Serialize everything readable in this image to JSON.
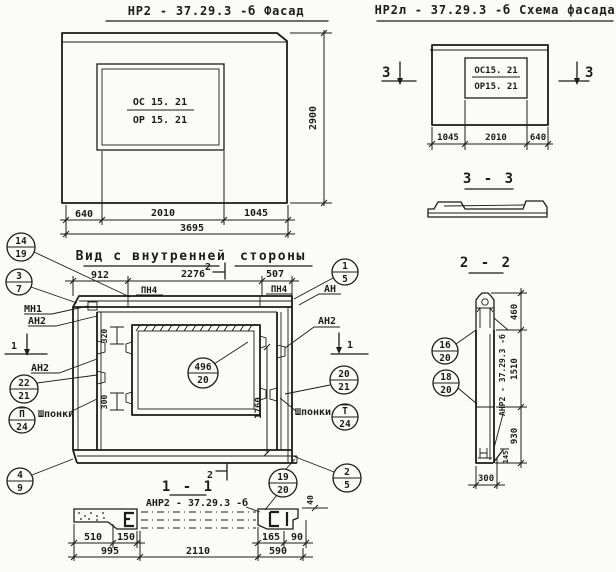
{
  "colors": {
    "ink": "#1b1b19",
    "paper": "#fbfbf8"
  },
  "facade": {
    "title": "НР2 - 37.29.3  -б   Фасад",
    "win_top": "ОС 15. 21",
    "win_bot": "ОР 15. 21",
    "dim_height": "2900",
    "dim_left": "640",
    "dim_mid": "2010",
    "dim_right": "1045",
    "dim_total": "3695"
  },
  "scheme": {
    "title": "НР2л - 37.29.3  -б  Схема фасада",
    "win_top": "ОС15. 21",
    "win_bot": "ОР15. 21",
    "dim_left": "1045",
    "dim_mid": "2010",
    "dim_right": "640",
    "sec_left": "3",
    "sec_right": "3"
  },
  "sec33": {
    "title": "3 - 3"
  },
  "sec22": {
    "title": "2 - 2",
    "mark": "АНР2 - 37.29.3 -б",
    "c16": {
      "t": "16",
      "b": "20"
    },
    "c18": {
      "t": "18",
      "b": "20"
    },
    "d460": "460",
    "d1510": "1510",
    "d930": "930",
    "d145": "145",
    "d300": "300"
  },
  "inner": {
    "title1": "Вид с внутренней",
    "title2": "стороны",
    "m2_top": "2",
    "m2_bot": "2",
    "d912": "912",
    "d2276": "2276",
    "d507": "507",
    "pn4_left": "ПН4",
    "pn4_right": "ПН4",
    "d320": "320",
    "d300": "300",
    "d1760": "1760",
    "win_call": {
      "t": "496",
      "b": "20"
    },
    "c14_19": {
      "t": "14",
      "b": "19"
    },
    "c3_7": {
      "t": "3",
      "b": "7"
    },
    "c22_21": {
      "t": "22",
      "b": "21"
    },
    "cP_24": {
      "t": "П",
      "b": "24"
    },
    "c4_9": {
      "t": "4",
      "b": "9"
    },
    "c1_5": {
      "t": "1",
      "b": "5"
    },
    "c20_21": {
      "t": "20",
      "b": "21"
    },
    "cT_24": {
      "t": "Т",
      "b": "24"
    },
    "c2_5": {
      "t": "2",
      "b": "5"
    },
    "c19_20": {
      "t": "19",
      "b": "20"
    },
    "mn1": "МН1",
    "an2_a": "АН2",
    "an2_b": "АН2",
    "an_r": "АН",
    "an2_r": "АН2",
    "m1_left": "1",
    "m1_right": "1",
    "shponki_left": "Шпонки",
    "shponki_right": "Шпонки"
  },
  "sec11": {
    "title": "1 - 1",
    "mark": "АНР2 - 37.29.3 -б",
    "d510": "510",
    "d150": "150",
    "d995": "995",
    "d2110": "2110",
    "d165": "165",
    "d590": "590",
    "d90": "90",
    "d40": "40"
  }
}
